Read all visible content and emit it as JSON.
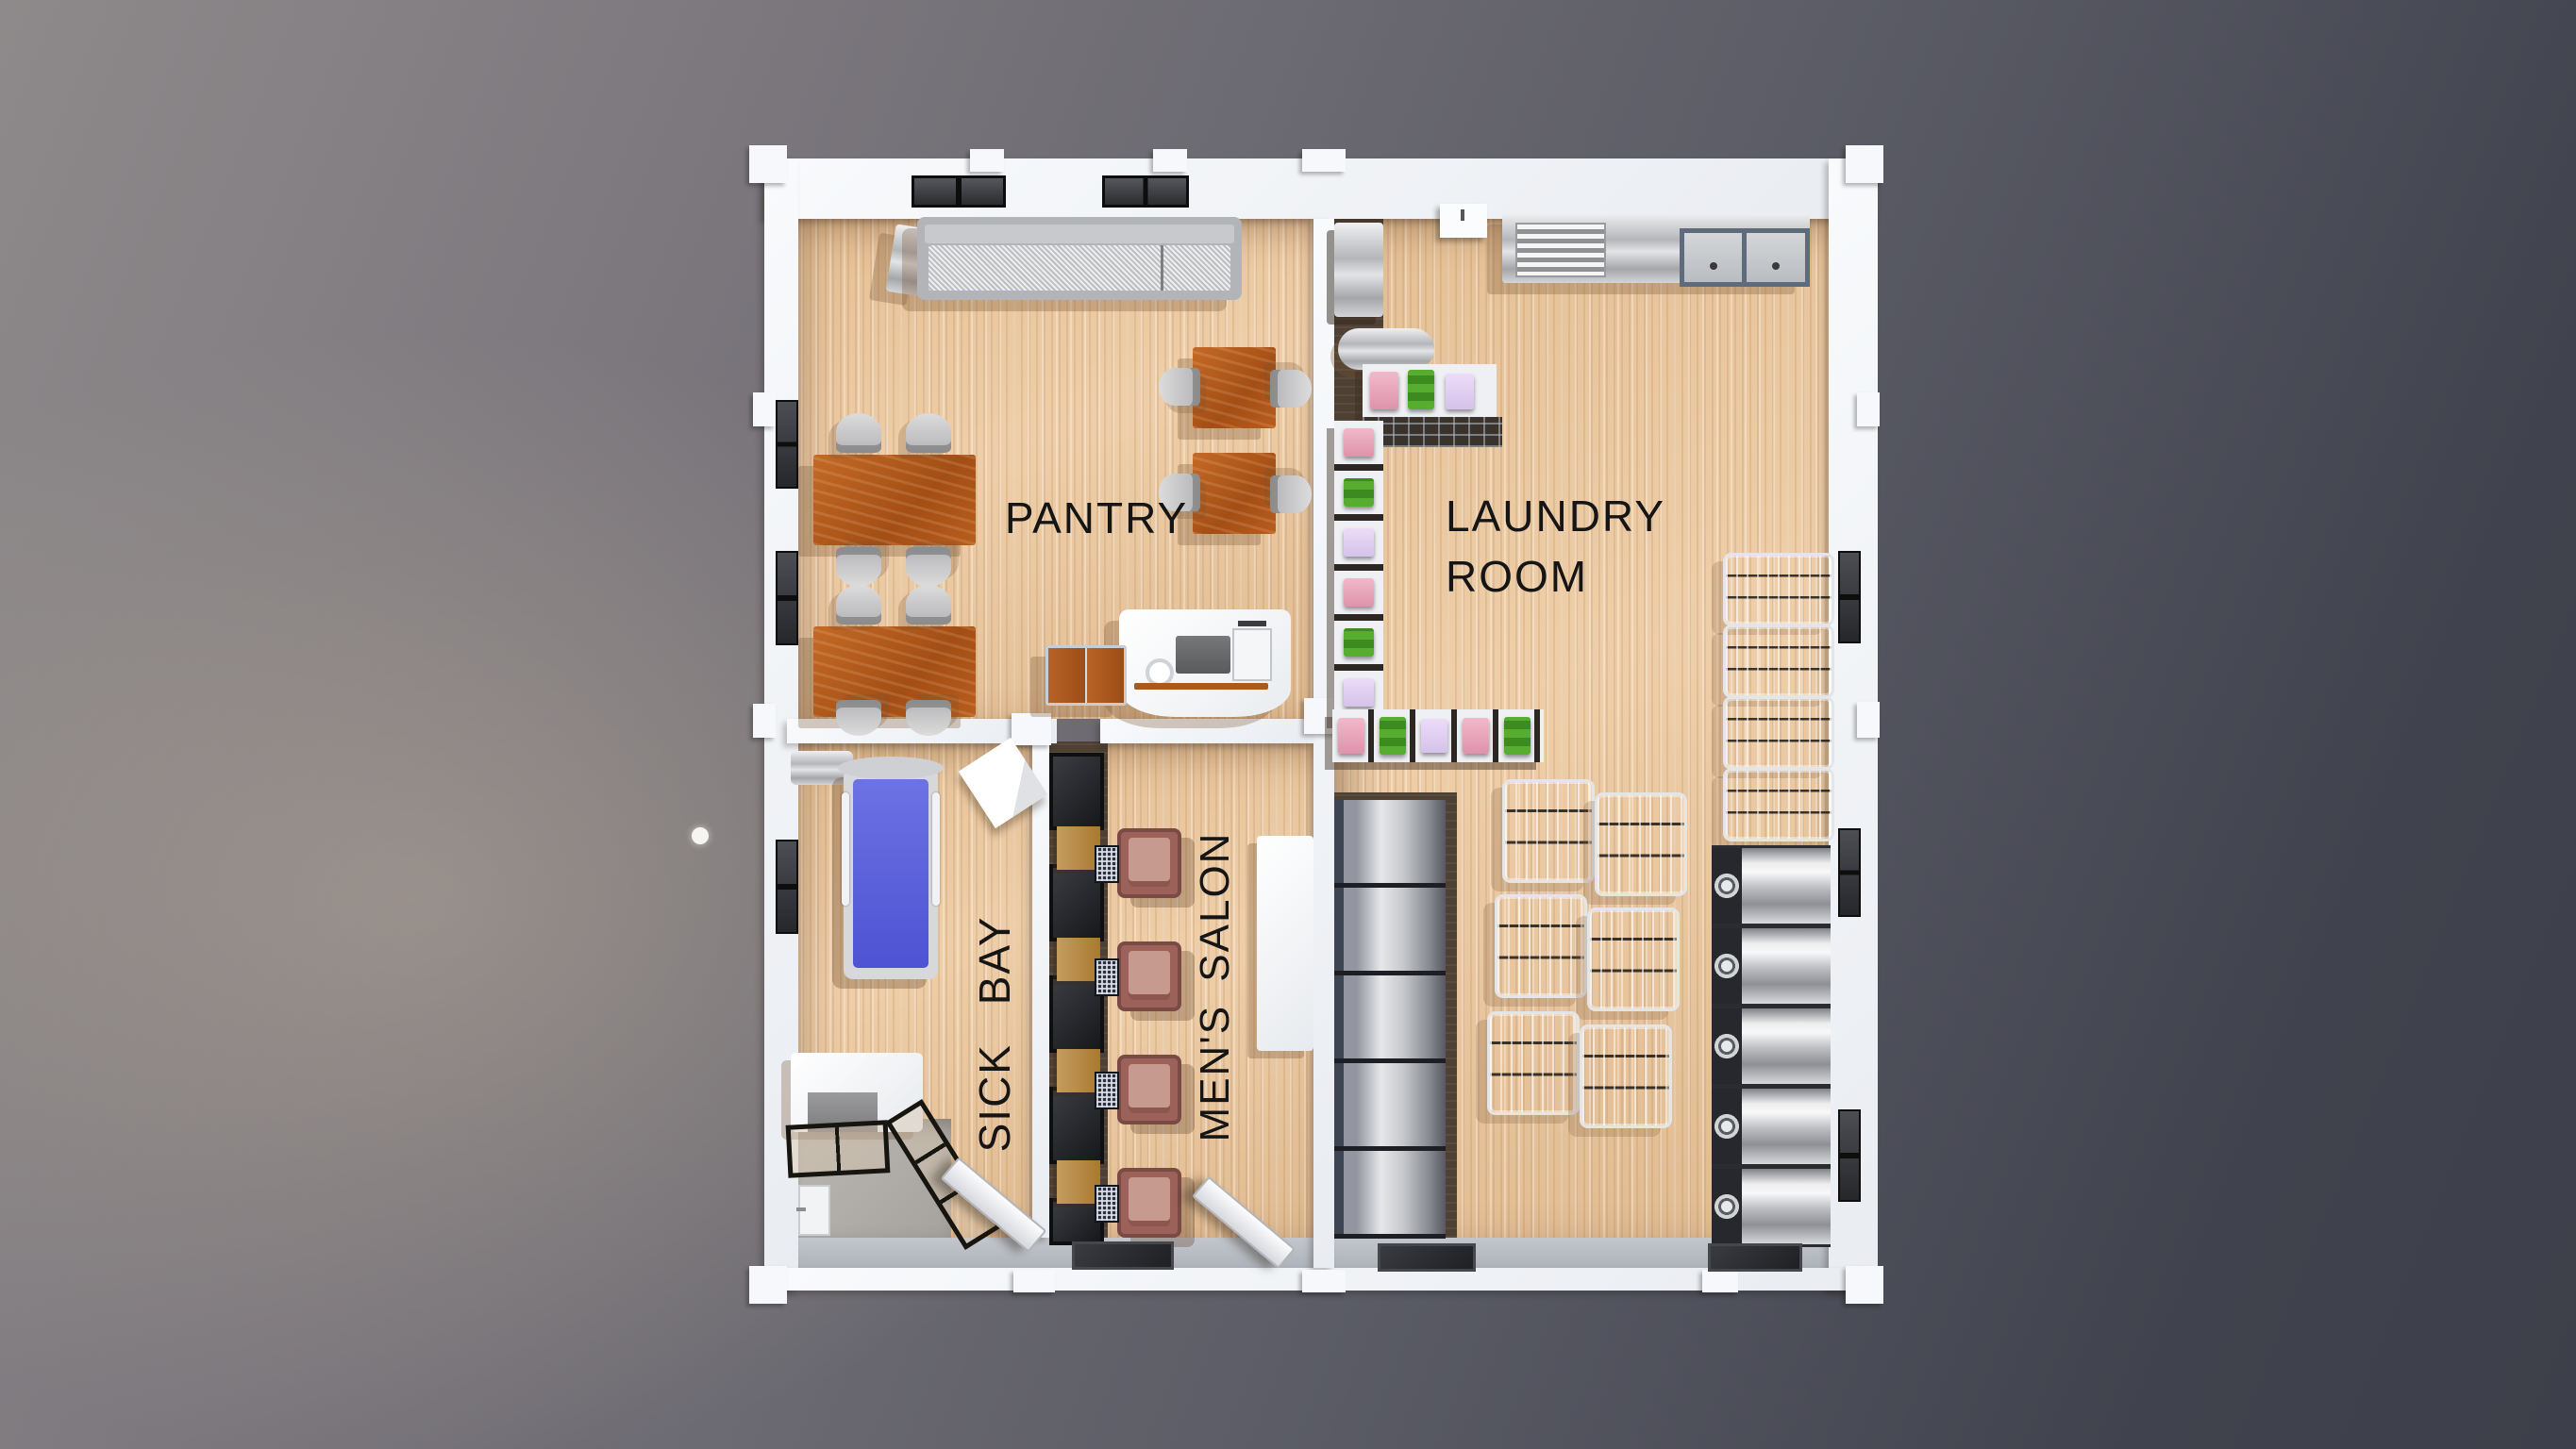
{
  "scene": {
    "type": "3d-floorplan-top-down-render"
  },
  "rooms": {
    "pantry": {
      "label": "PANTRY"
    },
    "laundry_room": {
      "label_line1": "LAUNDRY",
      "label_line2": "ROOM"
    },
    "sick_bay": {
      "label": "SICK BAY"
    },
    "mens_salon": {
      "label": "MEN'S SALON"
    }
  },
  "palette": {
    "background_dark": "#3d3f4a",
    "background_light": "#8e8a8b",
    "wall_white": "#f3f5f8",
    "wood_floor": "#ecc9a0",
    "dark_walkway": "#4e4134",
    "table_brown": "#b55d20",
    "bed_blue": "#5a60dd",
    "salon_chair_maroon": "#9c625a",
    "stainless": "#d9dadc",
    "towel_pink": "#e8a9bc",
    "towel_green": "#4da12d",
    "towel_lavender": "#e3d2f2",
    "label_text": "#151515"
  },
  "inventory": {
    "pantry": {
      "dining_tables": 2,
      "square_tables": 2,
      "gray_chairs": 12,
      "buffet_counters": 1,
      "service_counters": 1
    },
    "laundry_room": {
      "front_load_washers": 5,
      "utility_machines": 5,
      "wire_laundry_carts": 10,
      "sinks": 2,
      "towel_shelves": 3
    },
    "sick_bay": {
      "beds": 1,
      "desks": 1,
      "closets": 1
    },
    "mens_salon": {
      "styling_chairs": 4,
      "mirrors": 5,
      "wood_cabinets": 4
    }
  }
}
